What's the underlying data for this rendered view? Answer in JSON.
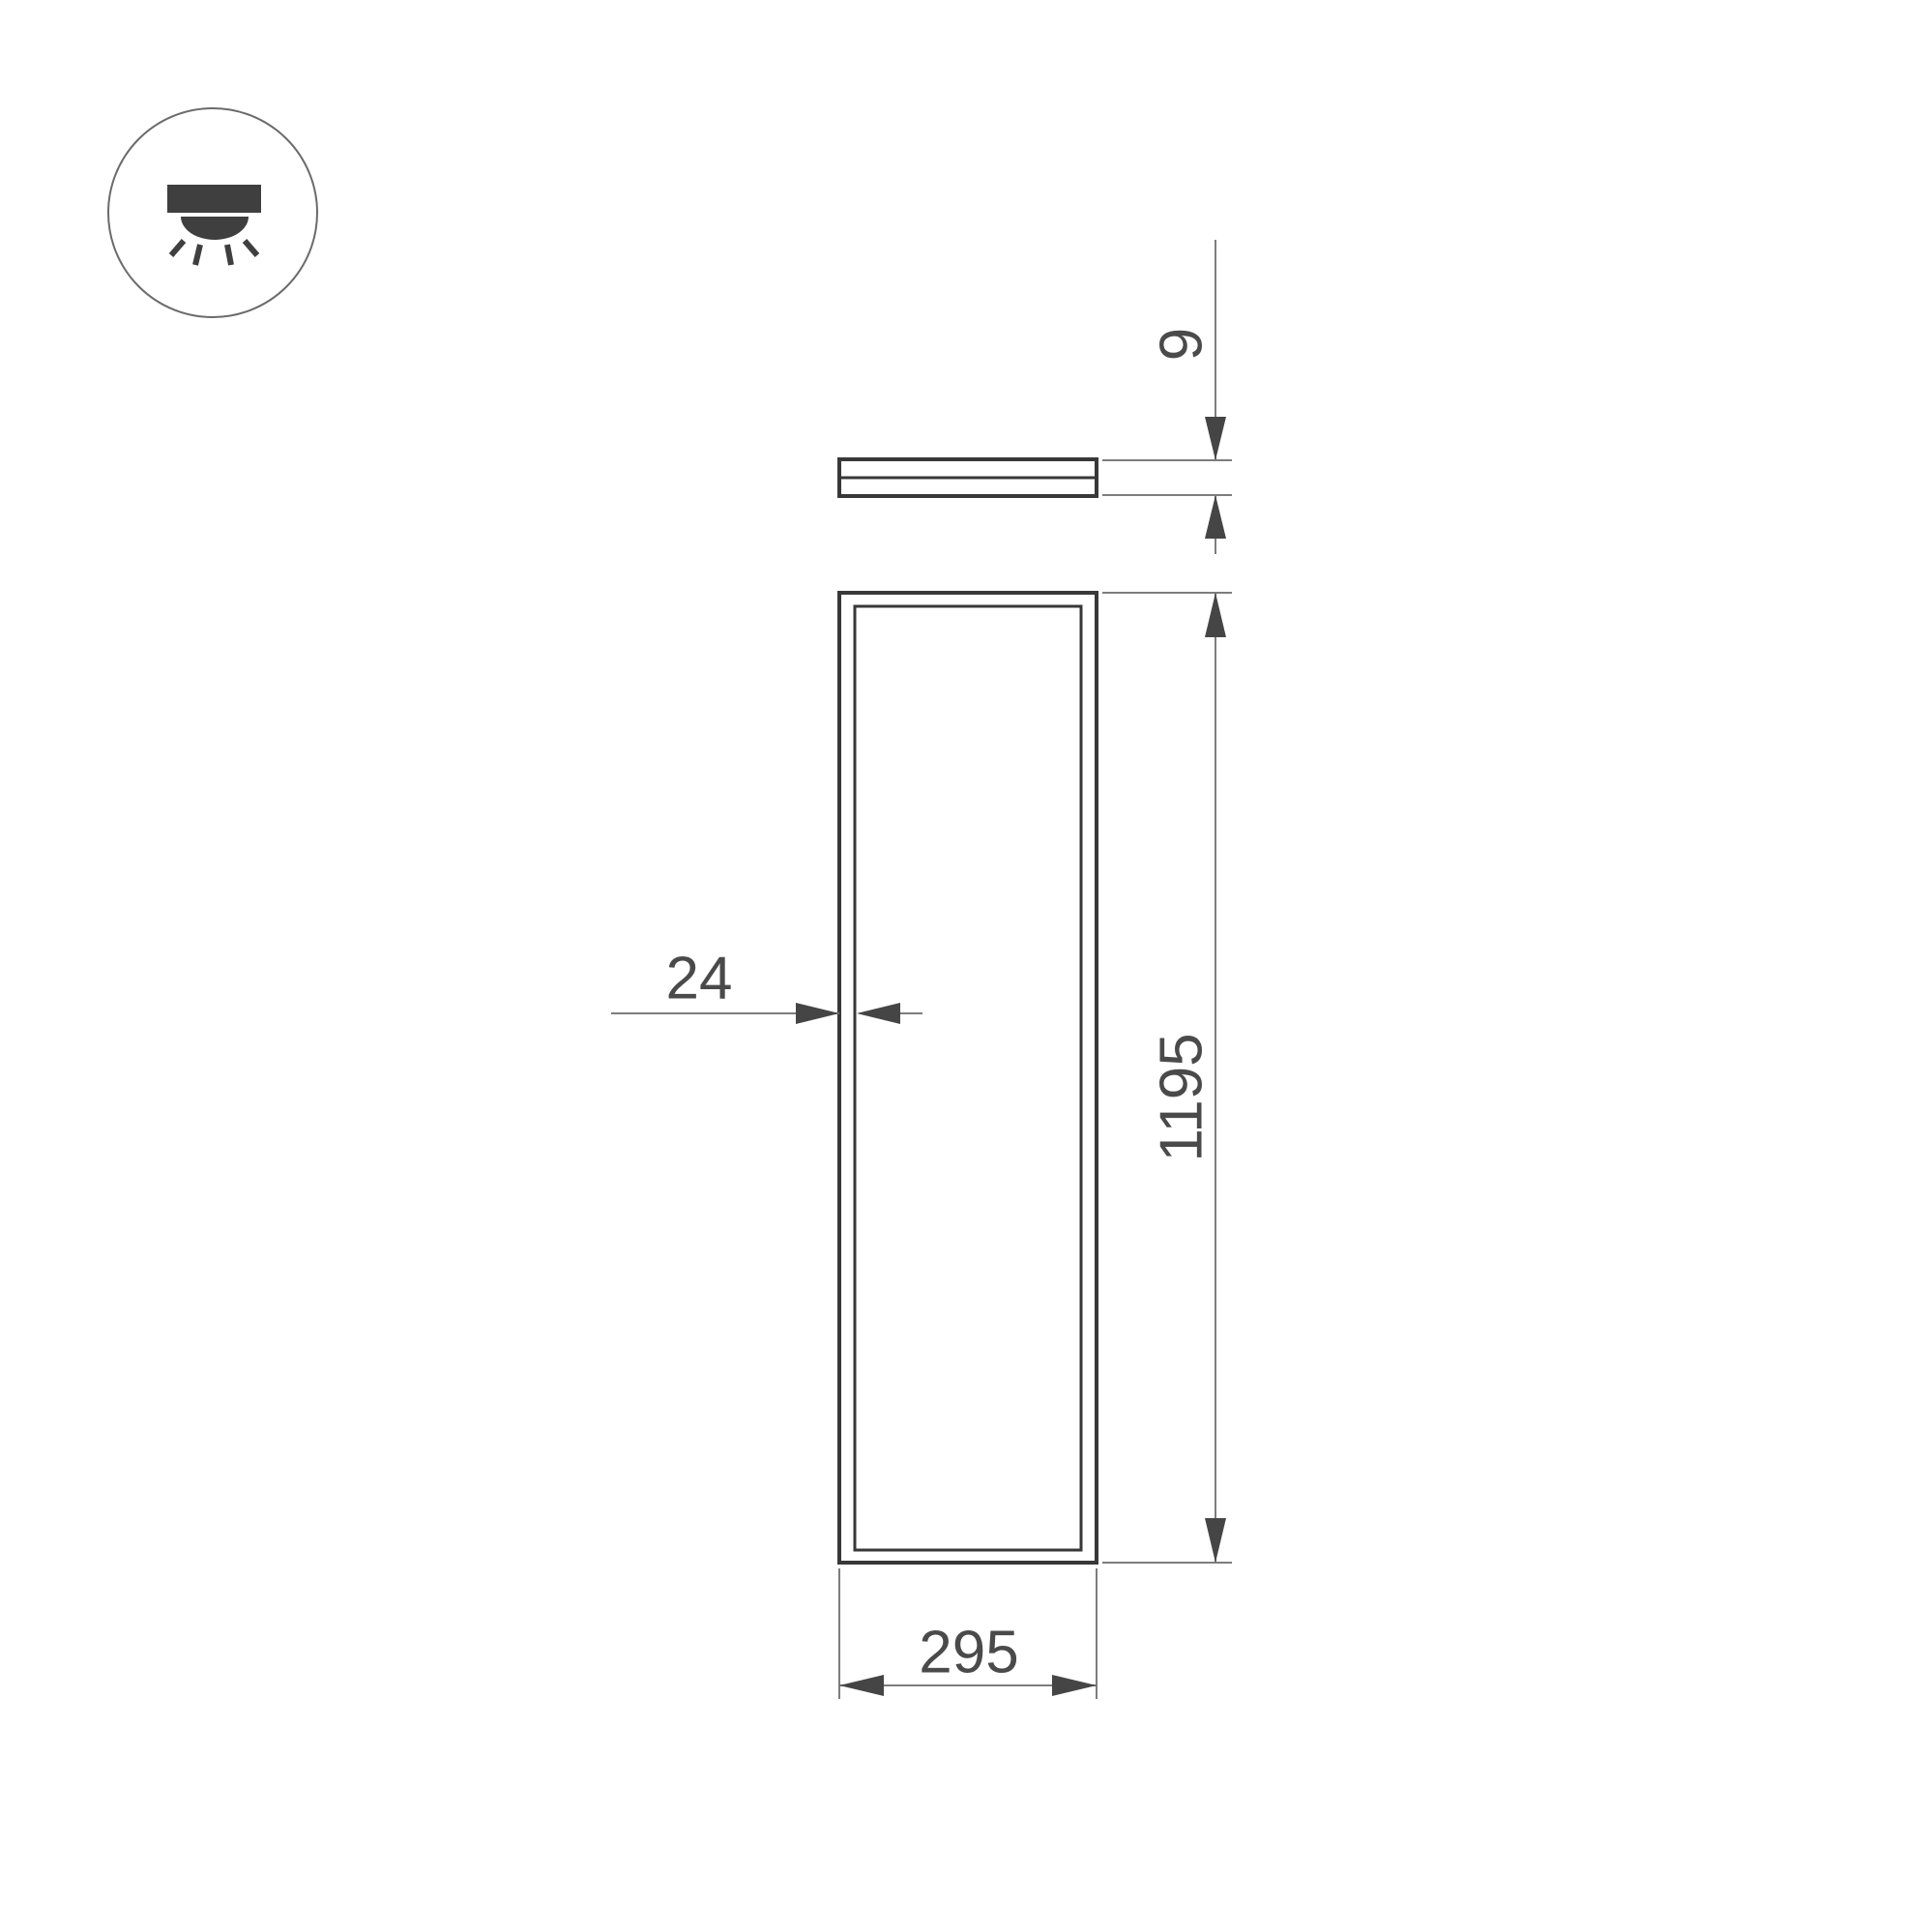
{
  "drawing": {
    "icon": {
      "name": "downlight-icon"
    },
    "dimensions": {
      "thickness": "9",
      "body_height": "1195",
      "body_width": "295",
      "frame_width": "24"
    },
    "colors": {
      "background": "#ffffff",
      "outline": "#383838",
      "dim_line": "#7d7d7d",
      "dim_text": "#4a4a4a",
      "arrow_fill": "#454545",
      "icon_fill": "#3f3f3f",
      "icon_circle_stroke": "#6b6b6b"
    }
  }
}
